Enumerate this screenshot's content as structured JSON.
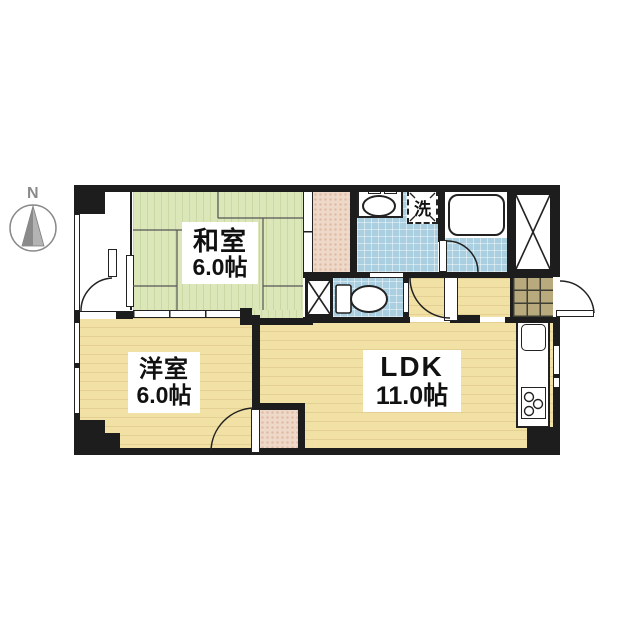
{
  "compass": {
    "north_label": "N"
  },
  "rooms": {
    "washitsu": {
      "name": "和室",
      "size": "6.0帖"
    },
    "youshitsu": {
      "name": "洋室",
      "size": "6.0帖"
    },
    "ldk": {
      "name": "LDK",
      "size": "11.0帖"
    }
  },
  "fixtures": {
    "washer_label": "洗"
  },
  "colors": {
    "tatami": "#dbe7b8",
    "wood": "#f1e1a5",
    "wet_area": "#aacfe0",
    "closet": "#eed8c8",
    "tile": "#b9aa7d",
    "wall": "#1d1d1d"
  }
}
